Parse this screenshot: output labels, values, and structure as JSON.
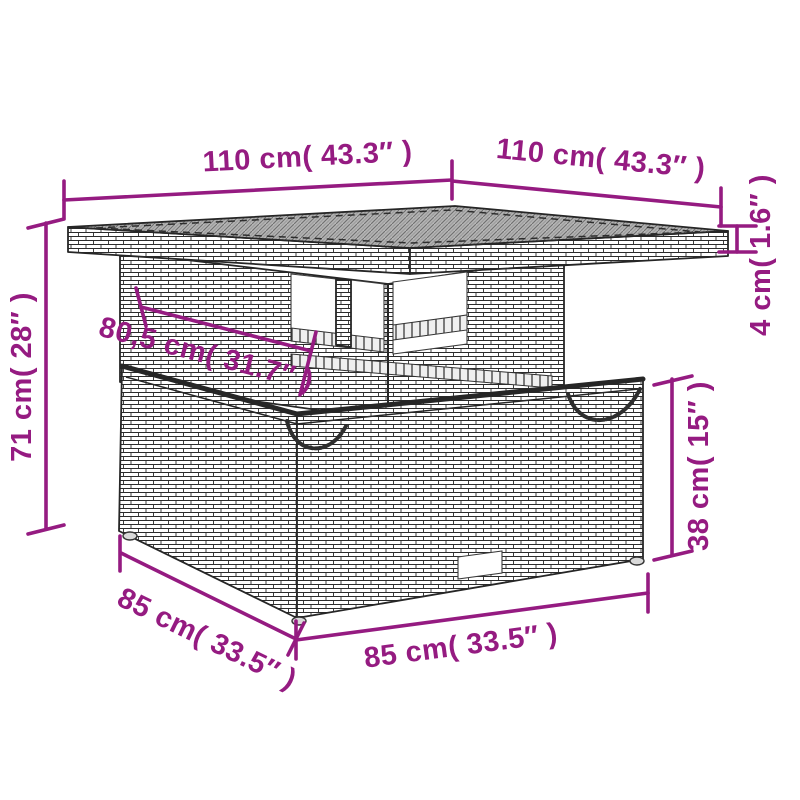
{
  "diagram": {
    "type": "product-dimension-diagram",
    "subject": "rattan-garden-table-with-storage-base",
    "colors": {
      "dimension_accent": "#951b81",
      "drawing_outline": "#262626",
      "tabletop_fill": "#b4b4b4",
      "background": "#ffffff"
    },
    "dimensions": {
      "top_width": {
        "label": "110 cm( 43.3″ )",
        "meaning": "tabletop width, front-left edge"
      },
      "top_depth": {
        "label": "110 cm( 43.3″ )",
        "meaning": "tabletop depth, front-right edge"
      },
      "top_thickness": {
        "label": "4 cm( 1.6″ )",
        "meaning": "tabletop thickness"
      },
      "total_height": {
        "label": "71 cm( 28″ )",
        "meaning": "overall height"
      },
      "shelf_width": {
        "label": "80,5 cm( 31.7″ )",
        "meaning": "inner pedestal width"
      },
      "base_height": {
        "label": "38 cm( 15″ )",
        "meaning": "storage base height"
      },
      "base_depth": {
        "label": "85 cm( 33.5″ )",
        "meaning": "storage base depth, left edge"
      },
      "base_width": {
        "label": "85 cm( 33.5″ )",
        "meaning": "storage base width, front edge"
      }
    }
  }
}
